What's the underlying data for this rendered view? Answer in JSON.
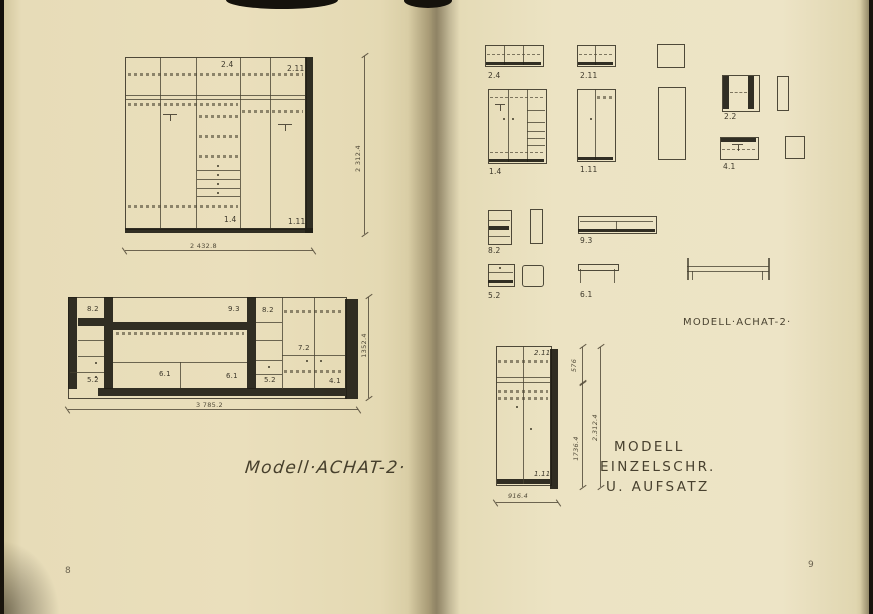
{
  "left": {
    "page_number": "8",
    "caption": "Modell·ACHAT-2·",
    "wardrobe": {
      "label_24": "2.4",
      "label_211": "2.11",
      "label_14": "1.4",
      "label_111": "1.11",
      "dim_width": "2 432.8",
      "dim_height": "2 312.4"
    },
    "wall_unit": {
      "label_82a": "8.2",
      "label_93": "9.3",
      "label_82b": "8.2",
      "label_72": "7.2",
      "label_52a": "5.2",
      "label_61a": "6.1",
      "label_61b": "6.1",
      "label_52b": "5.2",
      "label_41": "4.1",
      "dim_width": "3 785.2",
      "dim_height": "1352.4"
    }
  },
  "right": {
    "page_number": "9",
    "caption": "MODELL·ACHAT-2·",
    "items": {
      "i24": "2.4",
      "i211": "2.11",
      "i14": "1.4",
      "i111": "1.11",
      "i22": "2.2",
      "i41": "4.1",
      "i82": "8.2",
      "i93": "9.3",
      "i52": "5.2",
      "i61": "6.1"
    },
    "cabinet": {
      "top_label": "2.11",
      "bottom_label": "1.11",
      "dim_top": "576",
      "dim_body": "1736.4",
      "dim_total": "2.312.4",
      "dim_width": "916.4"
    },
    "note": {
      "line1": "MODELL",
      "line2": "EINZELSCHR.",
      "line3": "U. AUFSATZ"
    }
  }
}
